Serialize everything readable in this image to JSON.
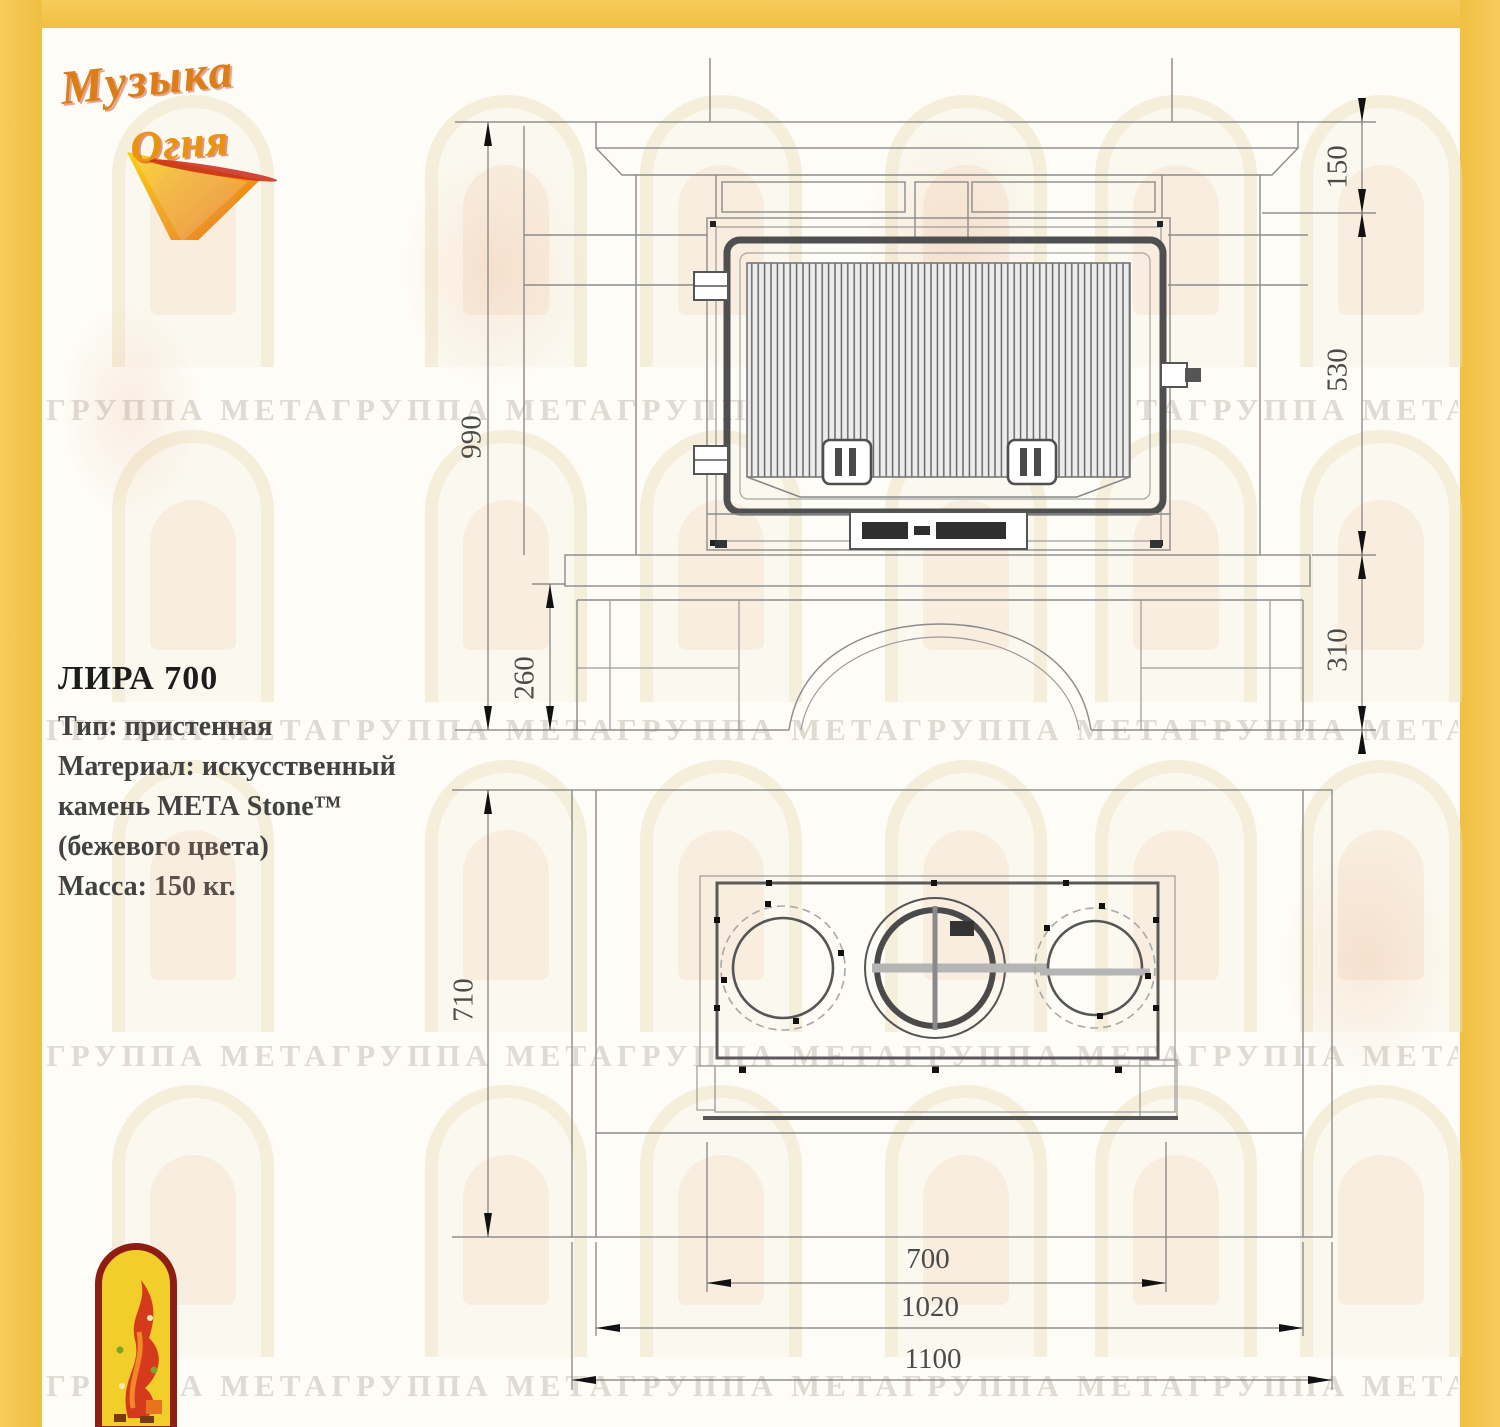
{
  "watermark": {
    "text": "ГРУППА МЕТАГРУППА МЕТАГРУППА МЕТАГРУППА МЕТАГРУППА МЕТАГРУППА МЕТА"
  },
  "brand": {
    "name_line1": "Музыка",
    "name_line2": "Огня"
  },
  "product": {
    "title": "ЛИРА 700",
    "spec_type": "Тип: пристенная",
    "spec_material_1": "Материал: искусственный",
    "spec_material_2": "камень МЕТА Stone™",
    "spec_material_3": "(бежевого цвета)",
    "spec_mass": "Масса: 150 кг."
  },
  "front_view": {
    "dim_overall_height": "990",
    "dim_top_section": "150",
    "dim_firebox_height": "530",
    "dim_base_right": "310",
    "dim_base_left": "260"
  },
  "top_view": {
    "dim_depth": "710",
    "dim_firebox_width": "700",
    "dim_body_width": "1020",
    "dim_overall_width": "1100"
  },
  "colors": {
    "accent_yellow": "#f3c64e",
    "line_gray": "#8b8b8b"
  }
}
